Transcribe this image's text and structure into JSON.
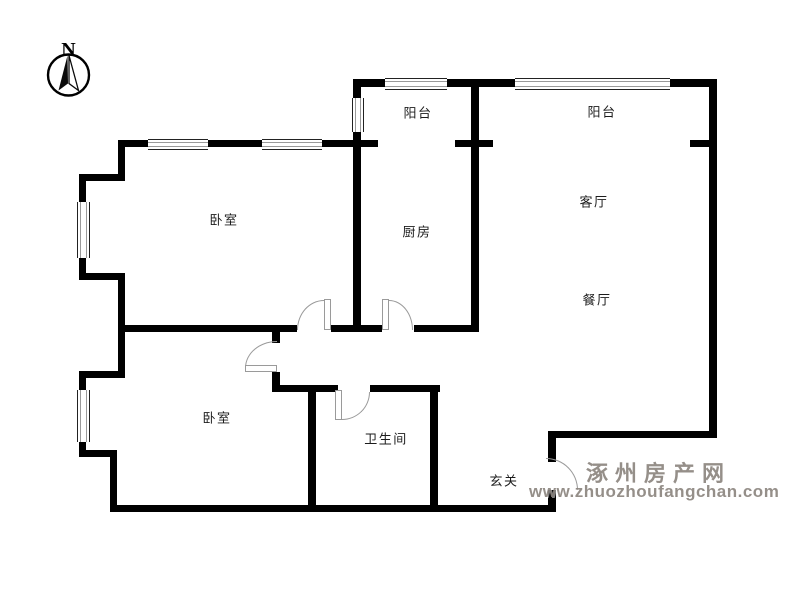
{
  "compass": {
    "label": "N"
  },
  "watermark": {
    "line1": "涿州房产网",
    "line2": "www.zhuozhoufangchan.com"
  },
  "colors": {
    "wall": "#000000",
    "door_line": "#9a9a9a",
    "window_line": "#9a9a9a",
    "label_text": "#1c1c1c",
    "watermark_text": "#8d8680"
  },
  "rooms": [
    {
      "name": "balcony-small",
      "label": "阳台",
      "cx": 418,
      "cy": 112
    },
    {
      "name": "balcony-large",
      "label": "阳台",
      "cx": 602,
      "cy": 111
    },
    {
      "name": "bedroom-top",
      "label": "卧室",
      "cx": 224,
      "cy": 219
    },
    {
      "name": "kitchen",
      "label": "厨房",
      "cx": 417,
      "cy": 231
    },
    {
      "name": "living-room",
      "label": "客厅",
      "cx": 594,
      "cy": 201
    },
    {
      "name": "dining-room",
      "label": "餐厅",
      "cx": 597,
      "cy": 299
    },
    {
      "name": "bedroom-bottom",
      "label": "卧室",
      "cx": 217,
      "cy": 417
    },
    {
      "name": "bathroom",
      "label": "卫生间",
      "cx": 386,
      "cy": 438
    },
    {
      "name": "entry-hall",
      "label": "玄关",
      "cx": 504,
      "cy": 480
    }
  ],
  "floor_plan": {
    "walls": [
      [
        353,
        79,
        32,
        8
      ],
      [
        447,
        79,
        68,
        8
      ],
      [
        670,
        79,
        47,
        8
      ],
      [
        709,
        79,
        8,
        359
      ],
      [
        353,
        79,
        8,
        19
      ],
      [
        353,
        132,
        8,
        200
      ],
      [
        471,
        79,
        8,
        253
      ],
      [
        118,
        140,
        30,
        7
      ],
      [
        208,
        140,
        54,
        7
      ],
      [
        322,
        140,
        56,
        7
      ],
      [
        455,
        140,
        38,
        7
      ],
      [
        690,
        140,
        27,
        7
      ],
      [
        118,
        140,
        7,
        41
      ],
      [
        79,
        174,
        46,
        7
      ],
      [
        79,
        174,
        7,
        28
      ],
      [
        79,
        258,
        7,
        22
      ],
      [
        79,
        273,
        43,
        7
      ],
      [
        118,
        273,
        7,
        105
      ],
      [
        79,
        371,
        45,
        7
      ],
      [
        79,
        371,
        7,
        19
      ],
      [
        79,
        442,
        7,
        15
      ],
      [
        79,
        450,
        38,
        7
      ],
      [
        110,
        450,
        7,
        62
      ],
      [
        110,
        505,
        446,
        7
      ],
      [
        548,
        490,
        8,
        22
      ],
      [
        118,
        325,
        179,
        7
      ],
      [
        331,
        325,
        51,
        7
      ],
      [
        414,
        325,
        65,
        7
      ],
      [
        272,
        325,
        8,
        18
      ],
      [
        272,
        372,
        8,
        20
      ],
      [
        272,
        385,
        66,
        7
      ],
      [
        370,
        385,
        70,
        7
      ],
      [
        308,
        385,
        8,
        127
      ],
      [
        430,
        388,
        8,
        124
      ],
      [
        548,
        431,
        8,
        31
      ],
      [
        548,
        431,
        169,
        7
      ]
    ],
    "windows": [
      {
        "x": 148,
        "y": 139,
        "w": 60,
        "h": 9,
        "dir": "h"
      },
      {
        "x": 262,
        "y": 139,
        "w": 60,
        "h": 9,
        "dir": "h"
      },
      {
        "x": 385,
        "y": 78,
        "w": 62,
        "h": 10,
        "dir": "h"
      },
      {
        "x": 515,
        "y": 78,
        "w": 155,
        "h": 10,
        "dir": "h"
      },
      {
        "x": 77,
        "y": 202,
        "w": 11,
        "h": 56,
        "dir": "v"
      },
      {
        "x": 77,
        "y": 390,
        "w": 11,
        "h": 52,
        "dir": "v"
      },
      {
        "x": 352,
        "y": 98,
        "w": 10,
        "h": 34,
        "dir": "v"
      }
    ],
    "doors": [
      {
        "name": "bedroom-top-door",
        "arc": [
          297,
          300,
          27,
          30
        ],
        "corner": "tl",
        "leaf": [
          324,
          299,
          7,
          31
        ]
      },
      {
        "name": "kitchen-door",
        "arc": [
          389,
          300,
          24,
          30
        ],
        "corner": "tr",
        "leaf": [
          382,
          299,
          7,
          31
        ]
      },
      {
        "name": "bedroom-bottom-door",
        "arc": [
          245,
          341,
          32,
          27
        ],
        "corner": "tl",
        "leaf": [
          245,
          365,
          32,
          7
        ]
      },
      {
        "name": "bathroom-door",
        "arc": [
          342,
          392,
          28,
          28
        ],
        "corner": "br",
        "leaf": [
          335,
          390,
          7,
          30
        ]
      },
      {
        "name": "entry-door",
        "arc": [
          546,
          458,
          32,
          32
        ],
        "corner": "tr",
        "leaf": null
      }
    ]
  }
}
